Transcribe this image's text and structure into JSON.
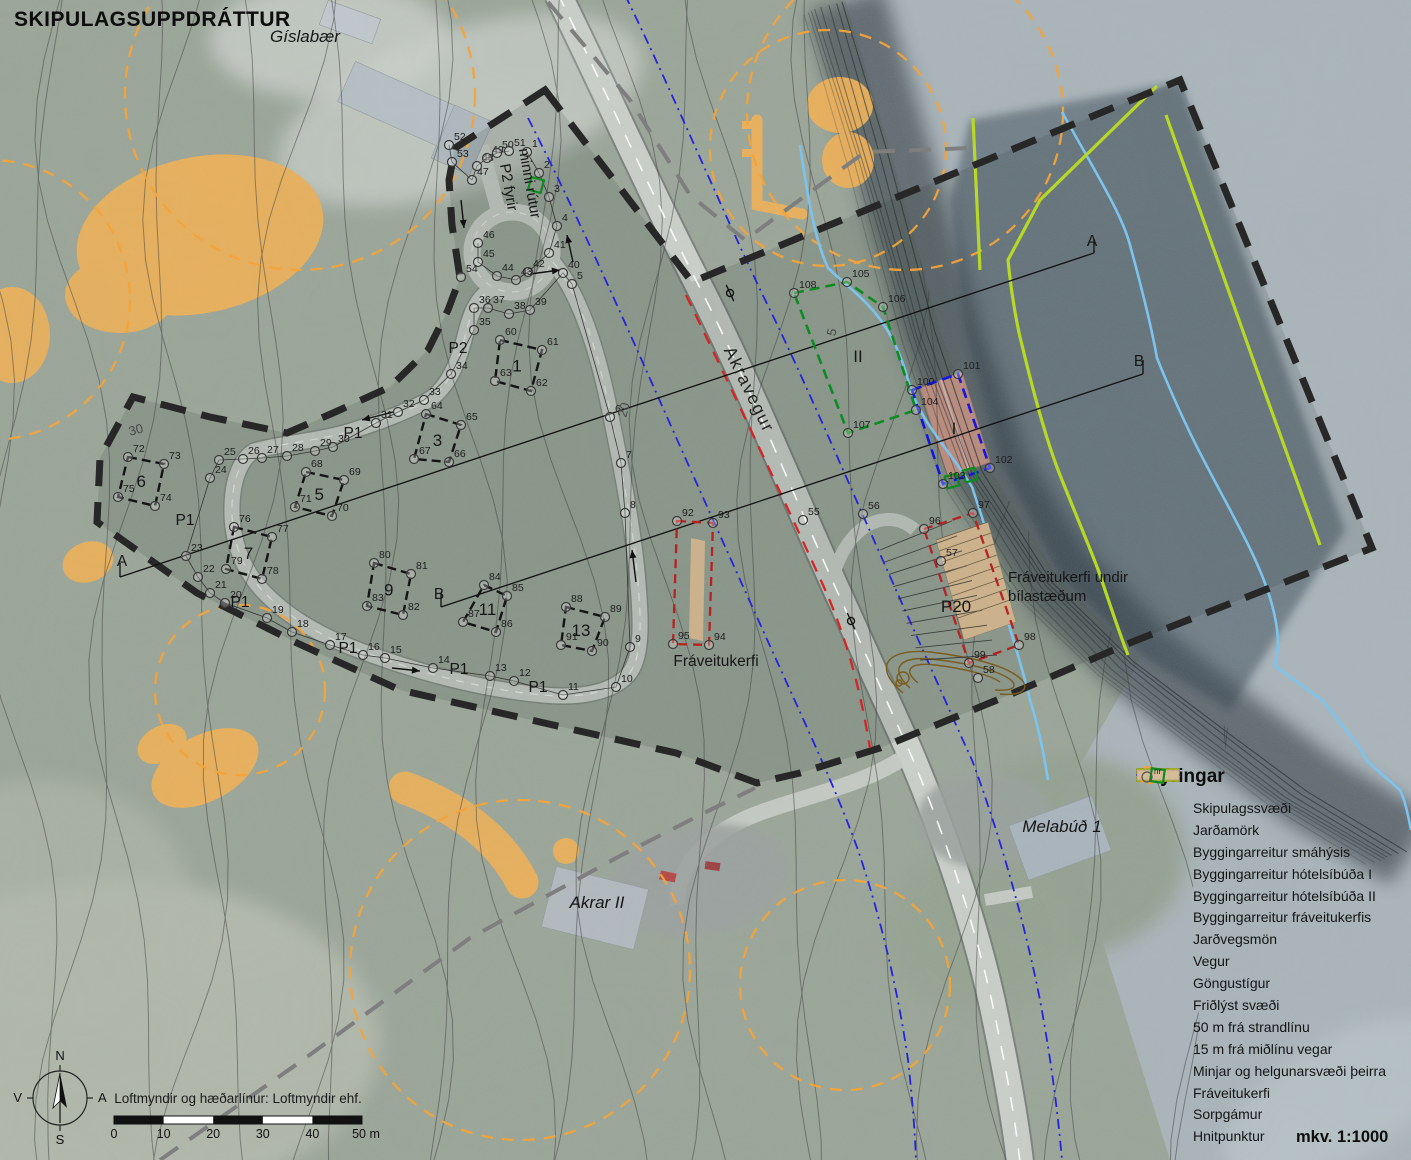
{
  "title": "SKIPULAGSUPPDRÁTTUR",
  "scale_label": "mkv. 1:1000",
  "credit": "Loftmyndir og hæðarlínur: Loftmyndir ehf.",
  "compass": {
    "n": "N",
    "s": "S",
    "e": "A",
    "w": "V"
  },
  "scalebar": {
    "ticks": [
      "0",
      "10",
      "20",
      "30",
      "40"
    ],
    "end": "50 m"
  },
  "legend": {
    "title": "Skýringar",
    "items": [
      {
        "label": "Skipulagssvæði",
        "type": "thickdash"
      },
      {
        "label": "Jarðamörk",
        "type": "graydash"
      },
      {
        "label": "Byggingarreitur smáhýsis",
        "type": "blackdash"
      },
      {
        "label": "Byggingarreitur hótelsíbúða I",
        "type": "bluedash"
      },
      {
        "label": "Byggingarreitur hótelsíbúða II",
        "type": "greendash"
      },
      {
        "label": "Byggingarreitur fráveitukerfis",
        "type": "darkreddash"
      },
      {
        "label": "Jarðvegsmön",
        "type": "brownrect"
      },
      {
        "label": "Vegur",
        "type": "road"
      },
      {
        "label": "Göngustígur",
        "type": "redline"
      },
      {
        "label": "Friðlýst svæði",
        "type": "limerect"
      },
      {
        "label": "50 m frá strandlínu",
        "type": "blueline"
      },
      {
        "label": "15 m frá miðlínu vegar",
        "type": "bluedashdot"
      },
      {
        "label": "Minjar og helgunarsvæði þeirra",
        "type": "orangecircle"
      },
      {
        "label": "Fráveitukerfi",
        "type": "tanrect"
      },
      {
        "label": "Sorpgámur",
        "type": "greensquare"
      },
      {
        "label": "Hnitpunktur",
        "type": "circlenr",
        "sup": "nr"
      }
    ]
  },
  "colors": {
    "boundary": "#272727",
    "jardamork": "#7e7e7e",
    "plot_dash": "#141414",
    "hotel1_blue": "#1515e2",
    "hotel2_green": "#0c8c20",
    "sewage_red": "#b52222",
    "path_red": "#d42525",
    "lime": "#b8d827",
    "coast_blue": "#7cc4ee",
    "road15_blue": "#2424dc",
    "orange": "#f3a33a",
    "orange_fill": "#f2b054",
    "tan": "#cbb28d",
    "brown": "#7a5c1e",
    "road_fill": "#cdd2cc",
    "contour": "#3f3f3f"
  },
  "map_labels": [
    {
      "t": "Gíslabær",
      "x": 305,
      "y": 42,
      "c": "it",
      "r": 0
    },
    {
      "t": "Akravegur",
      "x": 744,
      "y": 392,
      "c": "road",
      "r": 64
    },
    {
      "t": "Akrar II",
      "x": 597,
      "y": 908,
      "c": "it",
      "r": 0
    },
    {
      "t": "Melabúð 1",
      "x": 1062,
      "y": 832,
      "c": "it",
      "r": 0
    },
    {
      "t": "P2 fyrir",
      "x": 504,
      "y": 188,
      "c": "pl2",
      "r": 80
    },
    {
      "t": "minni rútur",
      "x": 525,
      "y": 184,
      "c": "pl2",
      "r": 80
    },
    {
      "t": "P1",
      "x": 353,
      "y": 438,
      "c": "pl",
      "r": 0
    },
    {
      "t": "P1",
      "x": 185,
      "y": 525,
      "c": "pl",
      "r": 0
    },
    {
      "t": "P1",
      "x": 240,
      "y": 607,
      "c": "pl",
      "r": 0
    },
    {
      "t": "P1",
      "x": 348,
      "y": 653,
      "c": "pl",
      "r": 0
    },
    {
      "t": "P1",
      "x": 459,
      "y": 674,
      "c": "pl",
      "r": 0
    },
    {
      "t": "P1",
      "x": 538,
      "y": 692,
      "c": "pl",
      "r": 0
    },
    {
      "t": "P2",
      "x": 458,
      "y": 353,
      "c": "pl",
      "r": 0
    },
    {
      "t": "30",
      "x": 137,
      "y": 434,
      "c": "ct",
      "r": -15
    },
    {
      "t": "20",
      "x": 628,
      "y": 411,
      "c": "ct",
      "r": -75
    },
    {
      "t": "5",
      "x": 836,
      "y": 333,
      "c": "ct",
      "r": -78
    },
    {
      "t": "A",
      "x": 122,
      "y": 566,
      "c": "sec",
      "r": 0
    },
    {
      "t": "A",
      "x": 1092,
      "y": 246,
      "c": "sec",
      "r": 0
    },
    {
      "t": "B",
      "x": 439,
      "y": 599,
      "c": "sec",
      "r": 0
    },
    {
      "t": "B",
      "x": 1139,
      "y": 366,
      "c": "sec",
      "r": 0
    },
    {
      "t": "Fráveitukerfi",
      "x": 716,
      "y": 666,
      "c": "area",
      "r": 0
    },
    {
      "t": "Fráveitukerfi undir",
      "x": 1008,
      "y": 582,
      "c": "note",
      "r": 0,
      "a": "start"
    },
    {
      "t": "bílastæðum",
      "x": 1008,
      "y": 601,
      "c": "note",
      "r": 0,
      "a": "start"
    }
  ],
  "points": [
    [
      1,
      527,
      152
    ],
    [
      2,
      539,
      173
    ],
    [
      3,
      549,
      197
    ],
    [
      4,
      557,
      226
    ],
    [
      5,
      572,
      284
    ],
    [
      6,
      610,
      417
    ],
    [
      7,
      621,
      463
    ],
    [
      8,
      625,
      513
    ],
    [
      9,
      630,
      647
    ],
    [
      10,
      616,
      687
    ],
    [
      11,
      563,
      695
    ],
    [
      12,
      514,
      681
    ],
    [
      13,
      490,
      676
    ],
    [
      14,
      433,
      668
    ],
    [
      15,
      385,
      658
    ],
    [
      16,
      363,
      655
    ],
    [
      17,
      330,
      645
    ],
    [
      18,
      292,
      632
    ],
    [
      19,
      267,
      618
    ],
    [
      20,
      225,
      603
    ],
    [
      21,
      210,
      593
    ],
    [
      22,
      198,
      577
    ],
    [
      23,
      186,
      556
    ],
    [
      24,
      210,
      478
    ],
    [
      25,
      219,
      460
    ],
    [
      26,
      243,
      459
    ],
    [
      27,
      262,
      458
    ],
    [
      28,
      287,
      456
    ],
    [
      29,
      315,
      451
    ],
    [
      30,
      333,
      447
    ],
    [
      31,
      376,
      423
    ],
    [
      32,
      398,
      412
    ],
    [
      33,
      424,
      400
    ],
    [
      34,
      451,
      374
    ],
    [
      35,
      474,
      330
    ],
    [
      36,
      474,
      308
    ],
    [
      37,
      488,
      308
    ],
    [
      38,
      509,
      314
    ],
    [
      39,
      530,
      310
    ],
    [
      40,
      563,
      273
    ],
    [
      41,
      549,
      253
    ],
    [
      42,
      528,
      272
    ],
    [
      43,
      516,
      280
    ],
    [
      44,
      497,
      276
    ],
    [
      45,
      478,
      262
    ],
    [
      46,
      478,
      243
    ],
    [
      47,
      472,
      180
    ],
    [
      48,
      477,
      166
    ],
    [
      49,
      487,
      158
    ],
    [
      50,
      497,
      153
    ],
    [
      51,
      509,
      151
    ],
    [
      52,
      449,
      145
    ],
    [
      53,
      452,
      162
    ],
    [
      54,
      461,
      277
    ],
    [
      55,
      803,
      520
    ],
    [
      56,
      863,
      514
    ],
    [
      57,
      941,
      561
    ],
    [
      58,
      978,
      678
    ],
    [
      60,
      500,
      340
    ],
    [
      61,
      542,
      350
    ],
    [
      62,
      531,
      391
    ],
    [
      63,
      495,
      381
    ],
    [
      64,
      426,
      414
    ],
    [
      65,
      461,
      425
    ],
    [
      66,
      449,
      462
    ],
    [
      67,
      414,
      459
    ],
    [
      68,
      306,
      472
    ],
    [
      69,
      344,
      480
    ],
    [
      70,
      332,
      516
    ],
    [
      71,
      295,
      507
    ],
    [
      72,
      128,
      457
    ],
    [
      73,
      164,
      464
    ],
    [
      74,
      155,
      506
    ],
    [
      75,
      118,
      497
    ],
    [
      76,
      234,
      527
    ],
    [
      77,
      272,
      537
    ],
    [
      78,
      262,
      579
    ],
    [
      79,
      226,
      569
    ],
    [
      80,
      374,
      563
    ],
    [
      81,
      411,
      574
    ],
    [
      82,
      403,
      615
    ],
    [
      83,
      367,
      606
    ],
    [
      84,
      484,
      585
    ],
    [
      85,
      507,
      596
    ],
    [
      86,
      496,
      632
    ],
    [
      87,
      463,
      622
    ],
    [
      88,
      566,
      607
    ],
    [
      89,
      605,
      617
    ],
    [
      90,
      592,
      651
    ],
    [
      91,
      561,
      645
    ],
    [
      92,
      677,
      521
    ],
    [
      93,
      713,
      523
    ],
    [
      94,
      709,
      645
    ],
    [
      95,
      673,
      644
    ],
    [
      96,
      924,
      529
    ],
    [
      97,
      973,
      513
    ],
    [
      98,
      1019,
      645
    ],
    [
      99,
      969,
      663
    ],
    [
      100,
      912,
      390
    ],
    [
      101,
      958,
      374
    ],
    [
      102,
      990,
      468
    ],
    [
      103,
      943,
      484
    ],
    [
      104,
      916,
      410
    ],
    [
      105,
      847,
      282
    ],
    [
      106,
      883,
      307
    ],
    [
      107,
      848,
      433
    ],
    [
      108,
      794,
      293
    ]
  ],
  "plots": [
    {
      "label": "1",
      "pts": [
        60,
        61,
        62,
        63
      ]
    },
    {
      "label": "3",
      "pts": [
        64,
        65,
        66,
        67
      ]
    },
    {
      "label": "5",
      "pts": [
        68,
        69,
        70,
        71
      ]
    },
    {
      "label": "6",
      "pts": [
        72,
        73,
        74,
        75
      ]
    },
    {
      "label": "7",
      "pts": [
        76,
        77,
        78,
        79
      ]
    },
    {
      "label": "9",
      "pts": [
        80,
        81,
        82,
        83
      ]
    },
    {
      "label": "11",
      "pts": [
        84,
        85,
        86,
        87
      ]
    },
    {
      "label": "13",
      "pts": [
        88,
        89,
        90,
        91
      ]
    }
  ],
  "areas": {
    "hotel1": {
      "label": "I",
      "pts": [
        100,
        101,
        102,
        103
      ],
      "label_xy": [
        954,
        434
      ]
    },
    "hotel2": {
      "label": "II",
      "pts": [
        108,
        105,
        106,
        104,
        107
      ],
      "label_xy": [
        858,
        362
      ]
    },
    "sewage_mid": {
      "pts": [
        92,
        93,
        94,
        95
      ]
    },
    "sewage_parking": {
      "label": "P20",
      "pts": [
        96,
        97,
        98,
        99
      ],
      "label_xy": [
        956,
        612
      ]
    }
  },
  "chains": [
    [
      5,
      6,
      7,
      8,
      9,
      10,
      11,
      12,
      13,
      14,
      15,
      16,
      17,
      18,
      19,
      20,
      21,
      22,
      23,
      24,
      25,
      26,
      27,
      28,
      29,
      30,
      31,
      32,
      33
    ],
    [
      33,
      34,
      35,
      36,
      37,
      38,
      39,
      40,
      5
    ],
    [
      41,
      42,
      43,
      44,
      45,
      46
    ],
    [
      52,
      53,
      47,
      48,
      49,
      50,
      51
    ],
    [
      1,
      2,
      3,
      4,
      41
    ]
  ]
}
